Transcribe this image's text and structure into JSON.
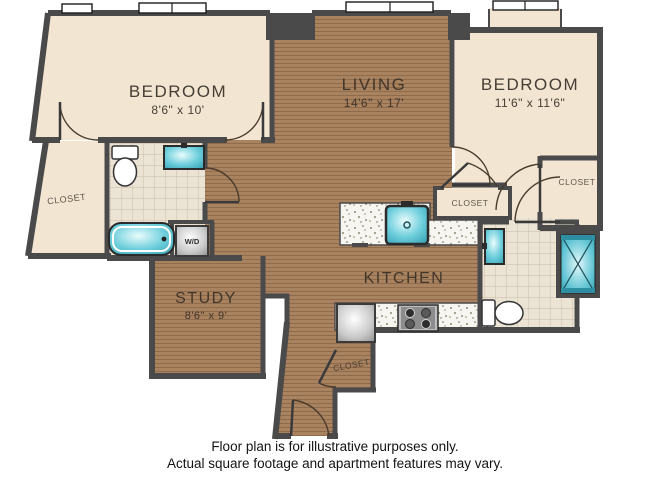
{
  "colors": {
    "wall": "#4a4a4a",
    "wood_floor": "#a9825f",
    "carpet_beige": "#f2e6d3",
    "tile": "#ebe3d4",
    "granite_counter": "#f7f5f0",
    "fixture_teal": "#55c3d3"
  },
  "rooms": [
    {
      "label": "BEDROOM",
      "dims": "8'6\" x 10'"
    },
    {
      "label": "LIVING",
      "dims": "14'6\" x 17'"
    },
    {
      "label": "BEDROOM",
      "dims": "11'6\" x 11'6\""
    },
    {
      "label": "KITCHEN",
      "dims": ""
    },
    {
      "label": "STUDY",
      "dims": "8'6\" x 9'"
    }
  ],
  "closets": {
    "left": "CLOSET",
    "kitchen": "CLOSET",
    "right": "CLOSET",
    "entry": "CLOSET"
  },
  "appliances": {
    "washer_dryer": "W/D"
  },
  "disclaimer": {
    "line1": "Floor plan is for illustrative purposes only.",
    "line2": "Actual square footage and apartment features may vary."
  }
}
